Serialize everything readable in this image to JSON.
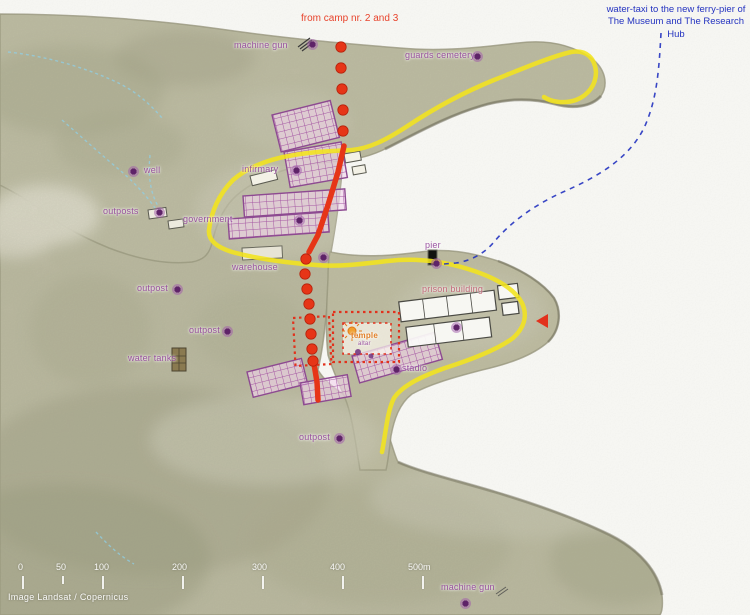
{
  "annotations": {
    "from_camp": "from camp nr. 2 and 3",
    "water_taxi_line1": "water-taxi to the new ferry-pier of",
    "water_taxi_line2": "The Museum and The Research Hub"
  },
  "attribution": "Image Landsat / Copernicus",
  "colors": {
    "route_red": "#e63517",
    "route_yellow": "#f2e41c",
    "route_blue": "#2433c0",
    "label_purple": "#8e3d96",
    "label_pink": "#c05f72",
    "label_orange": "#e07a1f",
    "sea": "#fbfbf8",
    "land": "#c5c2ab"
  },
  "labels": [
    {
      "id": "machine-gun-north",
      "text": "machine gun",
      "x": 234,
      "y": 40,
      "dot": [
        312,
        44
      ],
      "color": "purple"
    },
    {
      "id": "guards-cemetery",
      "text": "guards cemetery",
      "x": 405,
      "y": 50,
      "dot": [
        477,
        56
      ],
      "color": "purple"
    },
    {
      "id": "well",
      "text": "well",
      "x": 144,
      "y": 165,
      "dot": [
        133,
        171
      ],
      "color": "purple"
    },
    {
      "id": "infirmary",
      "text": "infirmary",
      "x": 242,
      "y": 164,
      "dot": [
        296,
        170
      ],
      "color": "purple"
    },
    {
      "id": "outposts",
      "text": "outposts",
      "x": 103,
      "y": 206,
      "dot": [
        159,
        212
      ],
      "color": "purple"
    },
    {
      "id": "government",
      "text": "government",
      "x": 183,
      "y": 214,
      "dot": [
        299,
        220
      ],
      "color": "purple"
    },
    {
      "id": "warehouse",
      "text": "warehouse",
      "x": 232,
      "y": 262,
      "dot": [
        323,
        257
      ],
      "color": "purple"
    },
    {
      "id": "pier",
      "text": "pier",
      "x": 425,
      "y": 240,
      "dot": [
        436,
        263
      ],
      "color": "purple"
    },
    {
      "id": "prison-building",
      "text": "prison building",
      "x": 422,
      "y": 284,
      "dot": [
        456,
        327
      ],
      "color": "pink"
    },
    {
      "id": "outpost-west",
      "text": "outpost",
      "x": 137,
      "y": 283,
      "dot": [
        177,
        289
      ],
      "color": "purple"
    },
    {
      "id": "outpost-mid",
      "text": "outpost",
      "x": 189,
      "y": 325,
      "dot": [
        227,
        331
      ],
      "color": "purple"
    },
    {
      "id": "water-tanks",
      "text": "water tanks",
      "x": 128,
      "y": 353,
      "color": "purple"
    },
    {
      "id": "temple",
      "text": "temple",
      "x": 351,
      "y": 331,
      "color": "orange",
      "size": 8
    },
    {
      "id": "temple-altar",
      "text": "altar",
      "x": 358,
      "y": 341,
      "color": "purple",
      "size": 6
    },
    {
      "id": "stadio",
      "text": "stadio",
      "x": 402,
      "y": 363,
      "dot": [
        396,
        369
      ],
      "color": "purple"
    },
    {
      "id": "outpost-south",
      "text": "outpost",
      "x": 299,
      "y": 432,
      "dot": [
        339,
        438
      ],
      "color": "purple"
    },
    {
      "id": "machine-gun-south",
      "text": "machine gun",
      "x": 441,
      "y": 582,
      "dot": [
        465,
        603
      ],
      "color": "purple"
    }
  ],
  "scale_bar": {
    "unit_labels": [
      {
        "t": "0",
        "x": 18
      },
      {
        "t": "50",
        "x": 56
      },
      {
        "t": "100",
        "x": 94
      },
      {
        "t": "200",
        "x": 172
      },
      {
        "t": "300",
        "x": 252
      },
      {
        "t": "400",
        "x": 330
      },
      {
        "t": "500m",
        "x": 408
      }
    ],
    "tick_xs": [
      22,
      62,
      102,
      182,
      262,
      342,
      422
    ],
    "label_y": 562,
    "tick_y": 576
  }
}
